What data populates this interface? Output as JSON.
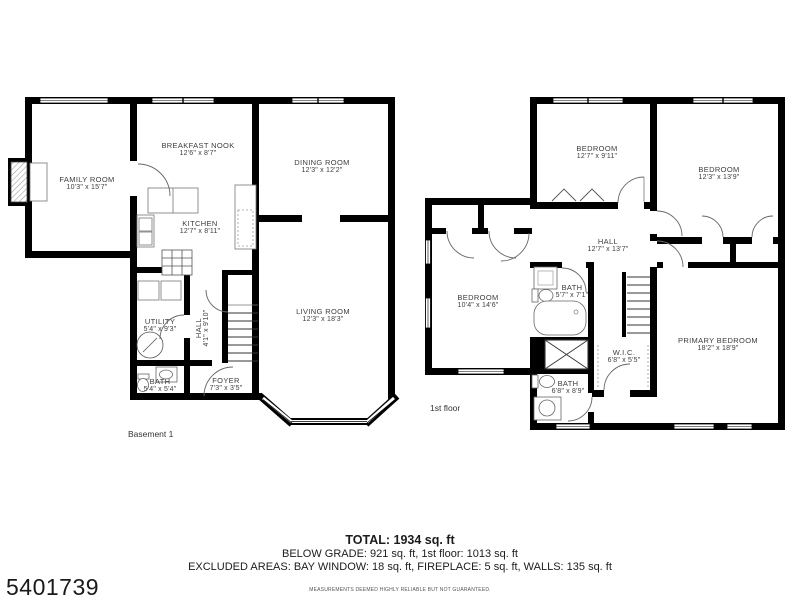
{
  "plans": [
    {
      "title": "Basement 1",
      "rooms": [
        {
          "name": "FAMILY ROOM",
          "dims": "10'3\" x 15'7\""
        },
        {
          "name": "BREAKFAST NOOK",
          "dims": "12'6\" x 8'7\""
        },
        {
          "name": "DINING ROOM",
          "dims": "12'3\" x 12'2\""
        },
        {
          "name": "KITCHEN",
          "dims": "12'7\" x 8'11\""
        },
        {
          "name": "LIVING ROOM",
          "dims": "12'3\" x 18'3\""
        },
        {
          "name": "UTILITY",
          "dims": "5'4\" x 9'3\""
        },
        {
          "name": "HALL",
          "dims": "4'1\" x 9'10\""
        },
        {
          "name": "BATH",
          "dims": "5'4\" x 5'4\""
        },
        {
          "name": "FOYER",
          "dims": "7'3\" x 3'5\""
        }
      ]
    },
    {
      "title": "1st floor",
      "rooms": [
        {
          "name": "BEDROOM",
          "dims": "12'7\" x 9'11\""
        },
        {
          "name": "BEDROOM",
          "dims": "12'3\" x 13'9\""
        },
        {
          "name": "HALL",
          "dims": "12'7\" x 13'7\""
        },
        {
          "name": "BEDROOM",
          "dims": "10'4\" x 14'6\""
        },
        {
          "name": "BATH",
          "dims": "5'7\" x 7'1\""
        },
        {
          "name": "W.I.C.",
          "dims": "6'8\" x 5'5\""
        },
        {
          "name": "BATH",
          "dims": "6'8\" x 8'9\""
        },
        {
          "name": "PRIMARY BEDROOM",
          "dims": "18'2\" x 18'9\""
        }
      ]
    }
  ],
  "summary": {
    "total": "TOTAL: 1934 sq. ft",
    "breakdown": "BELOW GRADE: 921 sq. ft, 1st floor: 1013 sq. ft",
    "excluded": "EXCLUDED AREAS: BAY WINDOW: 18 sq. ft, FIREPLACE: 5 sq. ft, WALLS: 135 sq. ft",
    "disclaimer": "MEASUREMENTS DEEMED HIGHLY RELIABLE BUT NOT GUARANTEED.",
    "listing_id": "5401739"
  },
  "colors": {
    "wall": "#000000",
    "label_text": "#3d3d3d",
    "background": "#ffffff"
  }
}
